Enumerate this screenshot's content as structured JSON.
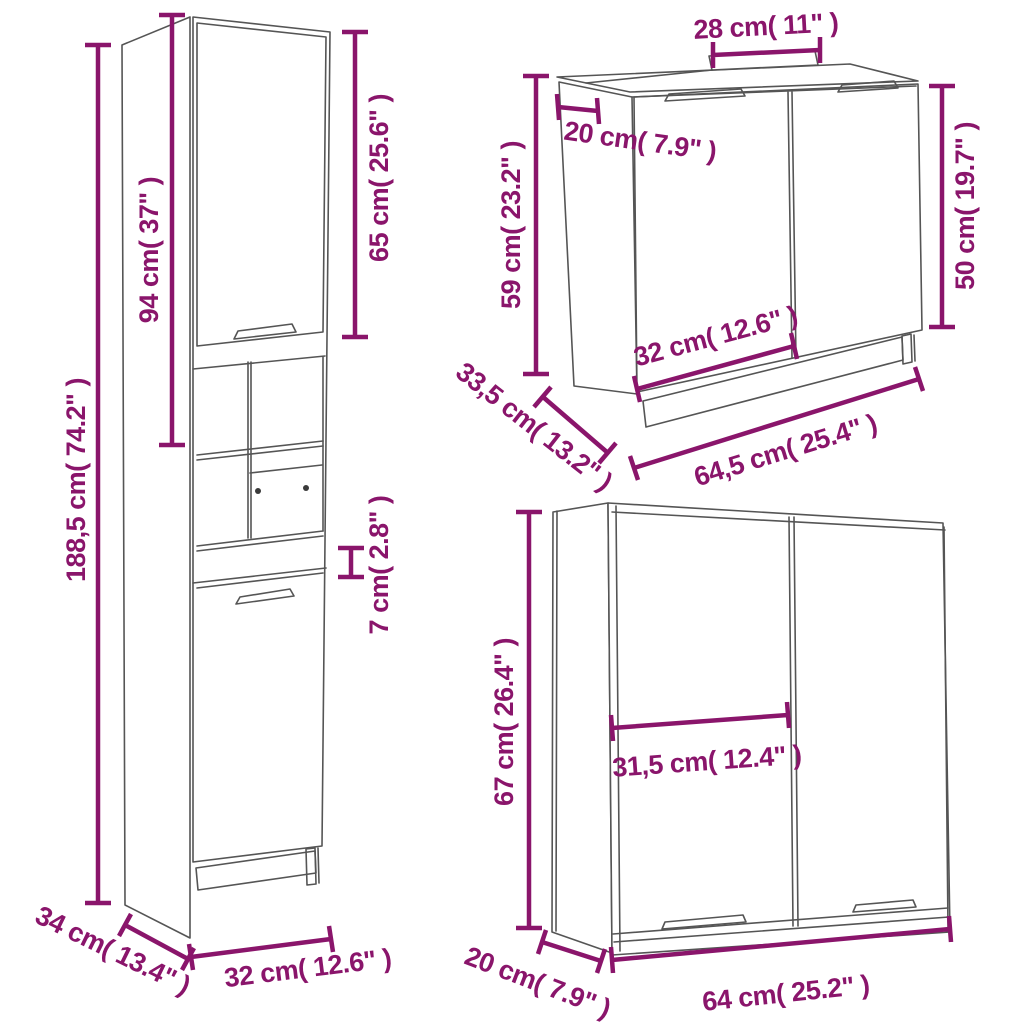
{
  "colors": {
    "dimension_accent": "#8A156B",
    "drawing_outline": "#555555",
    "background": "#FFFFFF"
  },
  "diagram": {
    "type": "furniture-dimension-diagram",
    "pieces": [
      "tall bathroom cabinet",
      "sink cabinet",
      "mirror cabinet"
    ]
  },
  "cabinets": {
    "tall": {
      "dimensions": {
        "total_height": "188,5 cm( 74.2\" )",
        "upper_section_height": "94 cm( 37\" )",
        "upper_door_height": "65 cm( 25.6\" )",
        "open_shelf_gap": "7 cm( 2.8\" )",
        "depth": "34 cm( 13.4\" )",
        "width": "32 cm( 12.6\" )"
      }
    },
    "sink": {
      "dimensions": {
        "cutout_width": "28 cm( 11\" )",
        "cutout_depth": "20 cm( 7.9\" )",
        "height": "59 cm( 23.2\" )",
        "door_height": "50 cm( 19.7\" )",
        "left_door_width": "32 cm( 12.6\" )",
        "depth": "33,5 cm( 13.2\" )",
        "width": "64,5 cm( 25.4\" )"
      }
    },
    "mirror": {
      "dimensions": {
        "height": "67 cm( 26.4\" )",
        "door_width": "31,5 cm( 12.4\" )",
        "depth": "20 cm( 7.9\" )",
        "width": "64 cm( 25.2\" )"
      }
    }
  }
}
